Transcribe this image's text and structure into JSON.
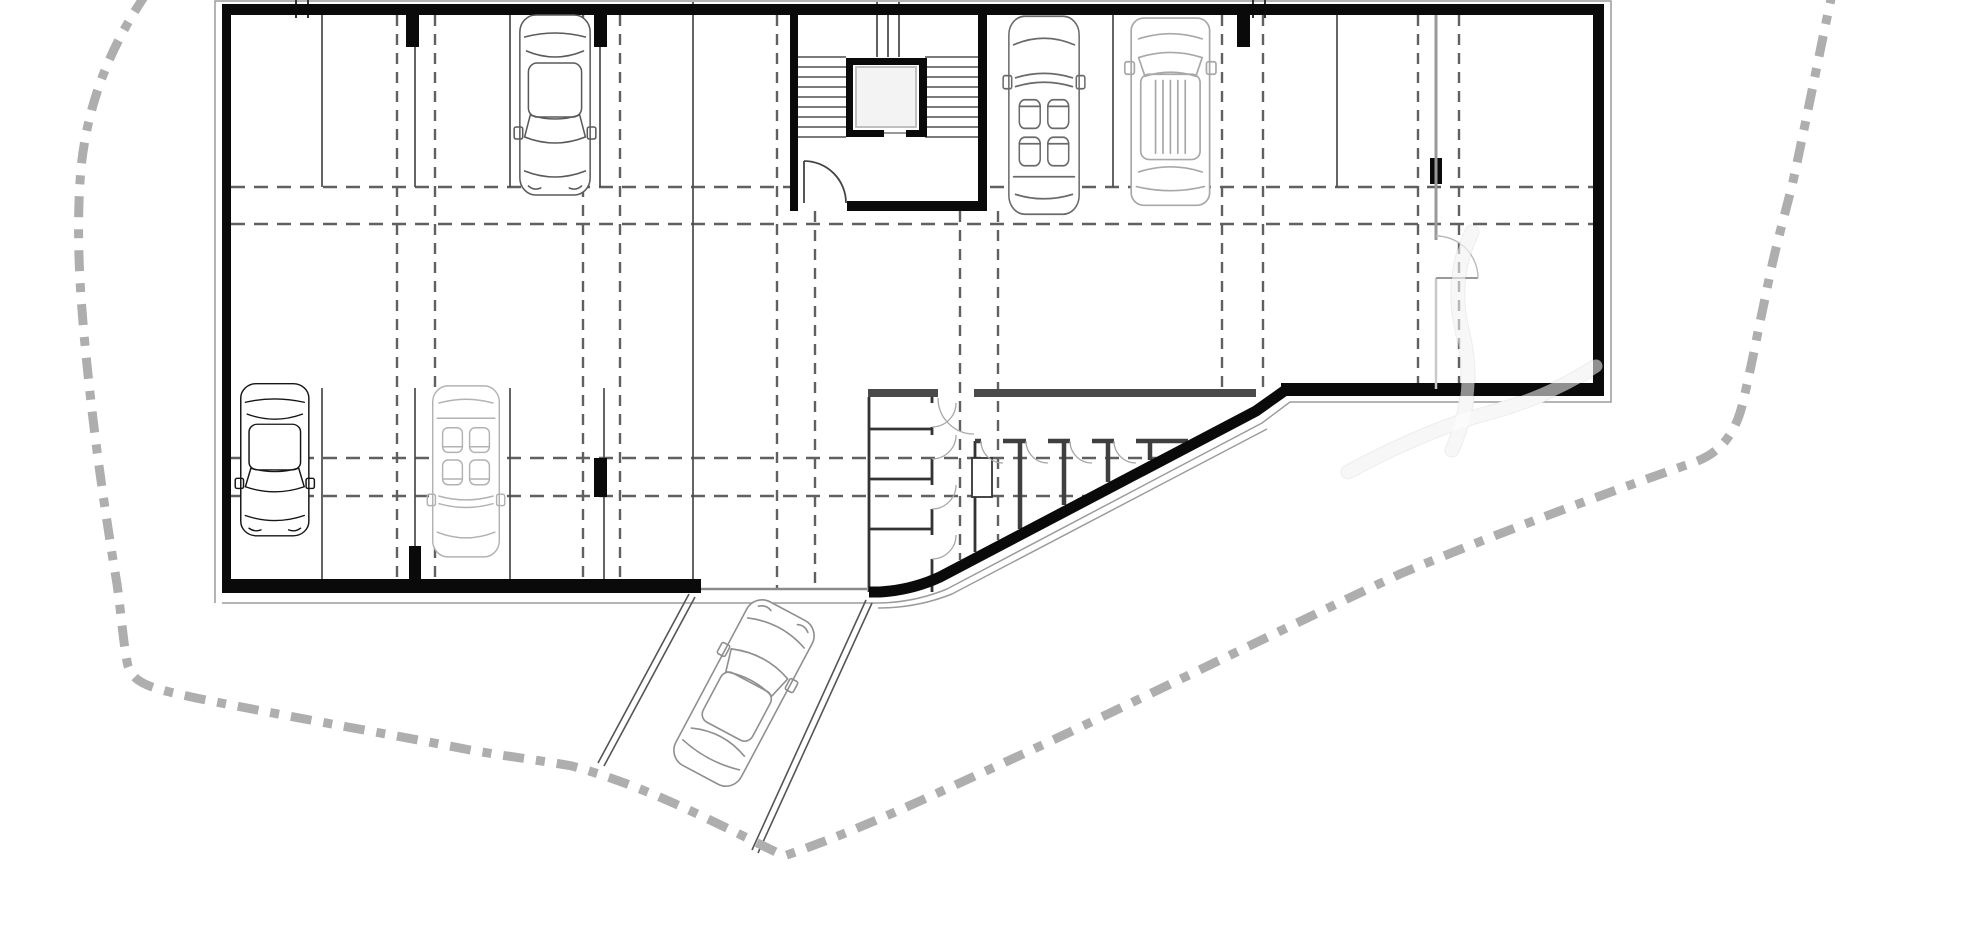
{
  "document": {
    "kind": "architectural-floor-plan",
    "subject": "underground parking garage level",
    "visible_text": [],
    "parked_cars": 5,
    "cars_on_ramp": 1,
    "storage_rooms": 9
  },
  "palette": {
    "background": "#ffffff",
    "wall": "#0a0a0a",
    "gray_wall": "#4a4a4a",
    "grid": "#606060",
    "bay_line": "#4a4a4a",
    "boundary": "#aeaeae",
    "offset_line": "#9c9c9c",
    "arc": "#a8a8a8"
  },
  "plan": {
    "canvas": {
      "width": 1973,
      "height": 931
    },
    "layers": [
      {
        "name": "site-offset-outline",
        "type": "paths",
        "style": {
          "stroke": "#9c9c9c",
          "width": 1.5,
          "fill": "none"
        },
        "items": [
          "M215,603 L215,1 L1611,1 L1611,402 L1290,402 L1262,423 L947,589 Q913,603 876,603 L222,603",
          "M1267,429 L952,594 Q917,608 878,608"
        ]
      },
      {
        "name": "watermark-under",
        "type": "paths",
        "style": {
          "stroke": "#ededed",
          "width": 15,
          "fill": "none",
          "cap": "round"
        },
        "items": [
          "M1348,472 Q1430,428 1492,412 Q1550,396 1596,366",
          "M1452,450 Q1478,392 1462,330 Q1450,278 1472,232"
        ]
      },
      {
        "name": "grid-lines-horizontal",
        "type": "lines",
        "style": {
          "stroke": "#606060",
          "width": 2.4,
          "dash": "14 9"
        },
        "items": [
          [
            231,
            187,
            1593,
            187
          ],
          [
            231,
            224,
            1593,
            224
          ],
          [
            231,
            458,
            1157,
            458
          ],
          [
            231,
            496,
            1086,
            496
          ]
        ]
      },
      {
        "name": "grid-lines-vertical",
        "type": "lines",
        "style": {
          "stroke": "#606060",
          "width": 2.4,
          "dash": "11 8"
        },
        "items": [
          [
            397,
            15,
            397,
            579
          ],
          [
            435,
            15,
            435,
            579
          ],
          [
            583,
            15,
            583,
            579
          ],
          [
            620,
            15,
            620,
            579
          ],
          [
            777,
            15,
            777,
            588
          ],
          [
            815,
            211,
            815,
            588
          ],
          [
            960,
            211,
            960,
            560
          ],
          [
            998,
            211,
            998,
            540
          ],
          [
            1222,
            15,
            1222,
            389
          ],
          [
            1263,
            15,
            1263,
            389
          ],
          [
            1418,
            15,
            1418,
            383
          ],
          [
            1459,
            15,
            1459,
            383
          ]
        ]
      },
      {
        "name": "parking-bay-lines",
        "type": "lines",
        "style": {
          "stroke": "#4a4a4a",
          "width": 1.7
        },
        "items": [
          [
            322,
            15,
            322,
            187
          ],
          [
            415,
            15,
            415,
            187
          ],
          [
            510,
            15,
            510,
            187
          ],
          [
            600,
            15,
            600,
            187
          ],
          [
            693,
            2,
            693,
            588
          ],
          [
            1113,
            15,
            1113,
            187
          ],
          [
            1337,
            15,
            1337,
            187
          ],
          [
            322,
            388,
            322,
            579
          ],
          [
            415,
            388,
            415,
            579
          ],
          [
            510,
            388,
            510,
            579
          ],
          [
            604,
            388,
            604,
            579
          ]
        ]
      },
      {
        "name": "grid-axis-ticks",
        "type": "lines",
        "style": {
          "stroke": "#333333",
          "width": 2
        },
        "items": [
          [
            296,
            0,
            296,
            18
          ],
          [
            308,
            0,
            308,
            18
          ],
          [
            1253,
            0,
            1253,
            18
          ],
          [
            1265,
            0,
            1265,
            18
          ]
        ]
      },
      {
        "name": "ramp-threshold-line",
        "type": "lines",
        "style": {
          "stroke": "#8a8a8a",
          "width": 2.5
        },
        "items": [
          [
            701,
            589,
            867,
            589
          ]
        ]
      },
      {
        "name": "stair-core-floor",
        "type": "rects",
        "style": {
          "fill": "#ffffff"
        },
        "items": [
          [
            798,
            15,
            180,
            185
          ]
        ]
      },
      {
        "name": "stair-treads",
        "type": "lines",
        "style": {
          "stroke": "#2b2b2b",
          "width": 1.2
        },
        "items": [
          [
            798,
            57,
            846,
            57
          ],
          [
            798,
            67,
            846,
            67
          ],
          [
            798,
            77,
            846,
            77
          ],
          [
            798,
            87,
            846,
            87
          ],
          [
            798,
            97,
            846,
            97
          ],
          [
            798,
            107,
            846,
            107
          ],
          [
            798,
            117,
            846,
            117
          ],
          [
            798,
            127,
            846,
            127
          ],
          [
            798,
            137,
            846,
            137
          ],
          [
            925,
            57,
            978,
            57
          ],
          [
            925,
            67,
            978,
            67
          ],
          [
            925,
            77,
            978,
            77
          ],
          [
            925,
            87,
            978,
            87
          ],
          [
            925,
            97,
            978,
            97
          ],
          [
            925,
            107,
            978,
            107
          ],
          [
            925,
            117,
            978,
            117
          ],
          [
            925,
            127,
            978,
            127
          ],
          [
            925,
            137,
            978,
            137
          ]
        ]
      },
      {
        "name": "stair-upper-flight",
        "type": "lines",
        "style": {
          "stroke": "#2b2b2b",
          "width": 1.5
        },
        "items": [
          [
            877,
            2,
            877,
            57
          ],
          [
            899,
            2,
            899,
            57
          ],
          [
            888,
            15,
            888,
            57
          ]
        ]
      },
      {
        "name": "elevator-shaft-walls",
        "type": "rects",
        "style": {
          "fill": "#0a0a0a"
        },
        "items": [
          [
            846,
            58,
            81,
            7
          ],
          [
            846,
            58,
            7,
            79
          ],
          [
            919,
            58,
            8,
            79
          ],
          [
            846,
            130,
            38,
            7
          ],
          [
            906,
            130,
            21,
            7
          ]
        ]
      },
      {
        "name": "elevator-cab",
        "type": "rects",
        "style": {
          "fill": "#f3f3f3",
          "stroke": "#c0c0c0",
          "width": 2
        },
        "items": [
          [
            856,
            67,
            60,
            60
          ]
        ]
      },
      {
        "name": "elevator-door-sill",
        "type": "lines",
        "style": {
          "stroke": "#999999",
          "width": 2
        },
        "items": [
          [
            884,
            133,
            906,
            133
          ]
        ]
      },
      {
        "name": "stair-core-door",
        "type": "paths",
        "style": {
          "stroke": "#444444",
          "width": 1.8,
          "fill": "none"
        },
        "items": [
          "M804,161 L804,203",
          "M804,161 A42,42 0 0 1 846,203"
        ]
      },
      {
        "name": "storage-room-walls",
        "type": "paths",
        "style": {
          "stroke": "#333333",
          "width": 2.8,
          "fill": "none"
        },
        "items": [
          "M869,397 L869,592",
          "M975,441 L975,552",
          "M932,397 L932,403",
          "M932,427 L932,435",
          "M932,459 L932,485",
          "M932,509 L932,535",
          "M932,559 L932,592",
          "M869,429 L932,429",
          "M869,479 L932,479",
          "M869,529 L932,529",
          "M982,458 L982,497"
        ]
      },
      {
        "name": "storage-locker-walls",
        "type": "paths",
        "style": {
          "stroke": "#3f3f3f",
          "width": 4.5,
          "fill": "none"
        },
        "items": [
          "M975,441 L981,441",
          "M1003,441 L1026,441",
          "M1048,441 L1070,441",
          "M1092,441 L1114,441",
          "M1136,441 L1188,441",
          "M1020,441 L1020,529",
          "M1064,441 L1064,505",
          "M1108,441 L1108,482",
          "M1150,441 L1150,460"
        ]
      },
      {
        "name": "storage-duct",
        "type": "rects",
        "style": {
          "fill": "#ffffff",
          "stroke": "#333333",
          "width": 1.8
        },
        "items": [
          [
            972,
            458,
            20,
            39
          ]
        ]
      },
      {
        "name": "door-swing-arcs",
        "type": "paths",
        "style": {
          "stroke": "#a8a8a8",
          "width": 1.3,
          "fill": "none"
        },
        "items": [
          "M956,403 A24,24 0 0 1 932,427",
          "M956,435 A24,24 0 0 1 932,459",
          "M956,485 A24,24 0 0 1 932,509",
          "M956,535 A24,24 0 0 1 932,559",
          "M938,398 A36,36 0 0 0 974,434",
          "M981,441 A22,22 0 0 0 1003,463",
          "M1026,441 A22,22 0 0 0 1048,463",
          "M1070,441 A22,22 0 0 0 1092,463",
          "M1114,441 A22,22 0 0 0 1136,463"
        ]
      },
      {
        "name": "exterior-walls",
        "type": "rects",
        "style": {
          "fill": "#0a0a0a"
        },
        "items": [
          [
            222,
            4,
            1382,
            11
          ],
          [
            222,
            4,
            9,
            589
          ],
          [
            222,
            579,
            479,
            14
          ],
          [
            1593,
            4,
            11,
            392
          ],
          [
            1281,
            383,
            323,
            13
          ],
          [
            790,
            15,
            8,
            196
          ],
          [
            978,
            15,
            9,
            196
          ],
          [
            847,
            201,
            140,
            10
          ]
        ]
      },
      {
        "name": "angled-retaining-wall",
        "type": "paths",
        "style": {
          "stroke": "#0a0a0a",
          "width": 11,
          "fill": "none",
          "join": "round"
        },
        "items": [
          "M1287,389 L1256,411 L940,577 Q912,590 880,592 L869,592"
        ]
      },
      {
        "name": "storage-front-wall",
        "type": "rects",
        "style": {
          "fill": "#4a4a4a"
        },
        "items": [
          [
            868,
            389,
            70,
            8
          ],
          [
            974,
            389,
            282,
            8
          ]
        ]
      },
      {
        "name": "structural-columns",
        "type": "rects",
        "style": {
          "fill": "#0a0a0a"
        },
        "items": [
          [
            406,
            15,
            13,
            32
          ],
          [
            594,
            15,
            13,
            32
          ],
          [
            1237,
            15,
            13,
            32
          ],
          [
            594,
            458,
            13,
            39
          ],
          [
            409,
            546,
            12,
            33
          ],
          [
            1430,
            158,
            12,
            26
          ]
        ]
      },
      {
        "name": "partition-wall-upper",
        "type": "lines",
        "style": {
          "stroke": "#999999",
          "width": 3
        },
        "items": [
          [
            1436,
            15,
            1436,
            240
          ]
        ]
      },
      {
        "name": "partition-wall-lower",
        "type": "lines",
        "style": {
          "stroke": "#c9c9c9",
          "width": 2.5
        },
        "items": [
          [
            1436,
            278,
            1436,
            389
          ]
        ]
      },
      {
        "name": "partition-door-leaf",
        "type": "paths",
        "style": {
          "stroke": "#999999",
          "width": 2,
          "fill": "none"
        },
        "items": [
          "M1436,278 L1478,278"
        ]
      },
      {
        "name": "partition-door-arc",
        "type": "paths",
        "style": {
          "stroke": "#bbbbbb",
          "width": 1.4,
          "fill": "none"
        },
        "items": [
          "M1478,278 A42,42 0 0 0 1436,236"
        ]
      },
      {
        "name": "ramp-edges",
        "type": "lines",
        "style": {
          "stroke": "#555555",
          "width": 1.6
        },
        "items": [
          [
            689,
            594,
            598,
            763
          ],
          [
            695,
            597,
            604,
            766
          ],
          [
            866,
            600,
            752,
            850
          ],
          [
            872,
            603,
            758,
            853
          ]
        ]
      },
      {
        "name": "cars",
        "type": "cars",
        "style": {
          "width": 1.6
        },
        "items": [
          {
            "kind": "sedan",
            "color": "#5a5a5a",
            "transform": "translate(517,13) scale(0.95,1) rotate(180 40 92)"
          },
          {
            "kind": "convertible",
            "color": "#6a6a6a",
            "transform": "translate(1006,14) scale(0.95,1.1)"
          },
          {
            "kind": "suv",
            "color": "#a8a8a8",
            "transform": "translate(1128,16) scale(1.06,1.04)"
          },
          {
            "kind": "sedan",
            "color": "#161616",
            "transform": "translate(238,382) scale(0.92,0.845) rotate(180 40 92)"
          },
          {
            "kind": "convertible",
            "color": "#b2b2b2",
            "transform": "translate(430,384) scale(0.9,0.95) rotate(180 40 92)"
          },
          {
            "kind": "sedan",
            "color": "#8f8f8f",
            "transform": "translate(744,693) rotate(28) scale(1,1.03) translate(-40,-92)"
          }
        ]
      },
      {
        "name": "property-boundary",
        "type": "paths",
        "style": {
          "stroke": "#aeaeae",
          "width": 9,
          "dash": "21 12 9 12",
          "fill": "none"
        },
        "items": [
          "M146,-6 C112,44 88,100 81,168 C75,240 81,310 89,384 C97,458 107,524 117,584 C121,612 124,650 128,666 C134,684 150,688 196,698 C300,719 400,736 470,750 C510,757 545,761 572,766 C645,786 706,818 784,856 C860,830 935,794 1010,760 C1140,700 1280,630 1400,574 C1500,532 1620,488 1695,462 C1722,452 1736,432 1743,402 C1752,364 1758,330 1766,294 C1772,262 1781,228 1792,186 C1803,136 1818,60 1832,-6"
        ]
      },
      {
        "name": "watermark-over",
        "type": "paths",
        "style": {
          "stroke": "rgba(255,255,255,0.55)",
          "width": 13,
          "fill": "none",
          "cap": "round"
        },
        "items": [
          "M1348,472 Q1430,428 1492,412 Q1550,396 1596,366",
          "M1452,450 Q1478,392 1462,330 Q1450,278 1472,232"
        ]
      }
    ]
  }
}
